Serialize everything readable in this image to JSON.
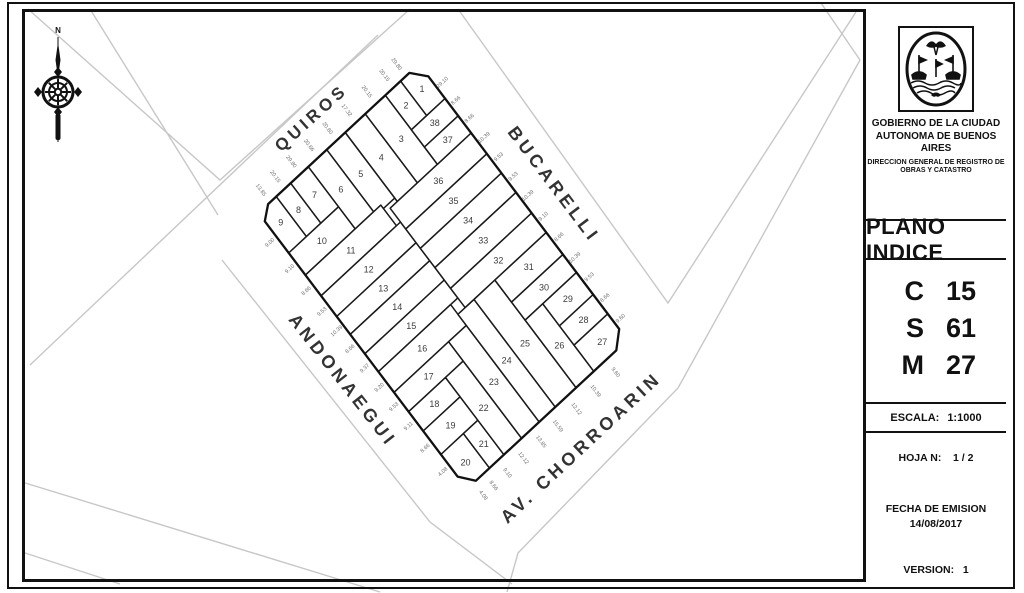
{
  "document": {
    "type_label": "PLANO INDICE",
    "org_line1": "GOBIERNO DE LA CIUDAD",
    "org_line2": "AUTONOMA DE BUENOS AIRES",
    "org_line3": "DIRECCION GENERAL DE REGISTRO DE",
    "org_line4": "OBRAS Y CATASTRO",
    "csm": [
      {
        "key": "C",
        "value": "15"
      },
      {
        "key": "S",
        "value": "61"
      },
      {
        "key": "M",
        "value": "27"
      }
    ],
    "escala_label": "ESCALA:",
    "escala_value": "1:1000",
    "hoja_label": "HOJA N:",
    "hoja_value": "1 / 2",
    "fecha_label": "FECHA DE EMISION",
    "fecha_value": "14/08/2017",
    "version_label": "VERSION:",
    "version_value": "1"
  },
  "colors": {
    "line": "#111111",
    "parcel_stroke": "#1a1a1a",
    "street_gray": "#c7c7c7",
    "label_gray": "#3d3d3d",
    "dim_gray": "#6e6e6e"
  },
  "map": {
    "compass": {
      "x": 58,
      "y": 92,
      "north_label": "N"
    },
    "frame": {
      "origin": [
        419,
        64
      ],
      "u": [
        208.5,
        276.0
      ],
      "v": [
        -160.5,
        149.0
      ]
    },
    "outline": [
      [
        0.045,
        0
      ],
      [
        0.96,
        0
      ],
      [
        1,
        0.07
      ],
      [
        1,
        0.945
      ],
      [
        0.955,
        1
      ],
      [
        0.03,
        1
      ],
      [
        0,
        0.94
      ],
      [
        0,
        0.06
      ]
    ],
    "streets": [
      {
        "name": "QUIROS",
        "x": 315,
        "y": 122,
        "rot": -42,
        "size": 17
      },
      {
        "name": "BUCARELLI",
        "x": 549,
        "y": 188,
        "rot": 53,
        "size": 18
      },
      {
        "name": "ANDONAEGUI",
        "x": 338,
        "y": 384,
        "rot": 52,
        "size": 18
      },
      {
        "name": "AV. CHORROARIN",
        "x": 585,
        "y": 452,
        "rot": -43,
        "size": 18
      }
    ],
    "parcels": [
      {
        "n": "1",
        "pts": [
          [
            0.045,
            0
          ],
          [
            0.125,
            0
          ],
          [
            0.125,
            0.115
          ],
          [
            0,
            0.115
          ],
          [
            0,
            0.06
          ]
        ]
      },
      {
        "n": "2",
        "pts": [
          [
            0,
            0.115
          ],
          [
            0.125,
            0.115
          ],
          [
            0.125,
            0.21
          ],
          [
            0,
            0.21
          ]
        ]
      },
      {
        "n": "3",
        "pts": [
          [
            0,
            0.21
          ],
          [
            0.25,
            0.21
          ],
          [
            0.25,
            0.335
          ],
          [
            0,
            0.335
          ]
        ]
      },
      {
        "n": "4",
        "pts": [
          [
            0,
            0.335
          ],
          [
            0.25,
            0.335
          ],
          [
            0.25,
            0.46
          ],
          [
            0,
            0.46
          ]
        ]
      },
      {
        "n": "5",
        "pts": [
          [
            0,
            0.46
          ],
          [
            0.2375,
            0.46
          ],
          [
            0.2375,
            0.575
          ],
          [
            0,
            0.575
          ]
        ]
      },
      {
        "n": "6",
        "pts": [
          [
            0,
            0.575
          ],
          [
            0.225,
            0.575
          ],
          [
            0.225,
            0.69
          ],
          [
            0,
            0.69
          ]
        ]
      },
      {
        "n": "7",
        "pts": [
          [
            0,
            0.69
          ],
          [
            0.145,
            0.69
          ],
          [
            0.145,
            0.8
          ],
          [
            0,
            0.8
          ]
        ]
      },
      {
        "n": "8",
        "pts": [
          [
            0,
            0.8
          ],
          [
            0.145,
            0.8
          ],
          [
            0.145,
            0.89
          ],
          [
            0,
            0.89
          ]
        ]
      },
      {
        "n": "9",
        "pts": [
          [
            0,
            0.89
          ],
          [
            0.145,
            0.89
          ],
          [
            0.145,
            1
          ],
          [
            0.03,
            1
          ],
          [
            0,
            0.94
          ]
        ]
      },
      {
        "n": "10",
        "pts": [
          [
            0.145,
            0.69
          ],
          [
            0.225,
            0.69
          ],
          [
            0.225,
            1
          ],
          [
            0.145,
            1
          ]
        ]
      },
      {
        "n": "11",
        "pts": [
          [
            0.225,
            0.53
          ],
          [
            0.3,
            0.53
          ],
          [
            0.3,
            1
          ],
          [
            0.225,
            1
          ]
        ]
      },
      {
        "n": "12",
        "pts": [
          [
            0.3,
            0.505
          ],
          [
            0.375,
            0.505
          ],
          [
            0.375,
            1
          ],
          [
            0.3,
            1
          ]
        ]
      },
      {
        "n": "13",
        "pts": [
          [
            0.375,
            0.505
          ],
          [
            0.44,
            0.505
          ],
          [
            0.44,
            1
          ],
          [
            0.375,
            1
          ]
        ]
      },
      {
        "n": "14",
        "pts": [
          [
            0.44,
            0.505
          ],
          [
            0.51,
            0.505
          ],
          [
            0.51,
            1
          ],
          [
            0.44,
            1
          ]
        ]
      },
      {
        "n": "15",
        "pts": [
          [
            0.51,
            0.505
          ],
          [
            0.575,
            0.505
          ],
          [
            0.575,
            1
          ],
          [
            0.51,
            1
          ]
        ]
      },
      {
        "n": "16",
        "pts": [
          [
            0.575,
            0.55
          ],
          [
            0.65,
            0.55
          ],
          [
            0.65,
            1
          ],
          [
            0.575,
            1
          ]
        ]
      },
      {
        "n": "17",
        "pts": [
          [
            0.65,
            0.66
          ],
          [
            0.72,
            0.66
          ],
          [
            0.72,
            1
          ],
          [
            0.65,
            1
          ]
        ]
      },
      {
        "n": "18",
        "pts": [
          [
            0.72,
            0.77
          ],
          [
            0.79,
            0.77
          ],
          [
            0.79,
            1
          ],
          [
            0.72,
            1
          ]
        ]
      },
      {
        "n": "19",
        "pts": [
          [
            0.79,
            0.77
          ],
          [
            0.875,
            0.77
          ],
          [
            0.875,
            1
          ],
          [
            0.79,
            1
          ]
        ]
      },
      {
        "n": "20",
        "pts": [
          [
            0.875,
            0.86
          ],
          [
            1,
            0.86
          ],
          [
            1,
            0.945
          ],
          [
            0.955,
            1
          ],
          [
            0.875,
            1
          ]
        ]
      },
      {
        "n": "21",
        "pts": [
          [
            0.875,
            0.77
          ],
          [
            1,
            0.77
          ],
          [
            1,
            0.86
          ],
          [
            0.875,
            0.86
          ]
        ]
      },
      {
        "n": "22",
        "pts": [
          [
            0.72,
            0.66
          ],
          [
            1,
            0.66
          ],
          [
            1,
            0.77
          ],
          [
            0.72,
            0.77
          ]
        ]
      },
      {
        "n": "23",
        "pts": [
          [
            0.65,
            0.55
          ],
          [
            1,
            0.55
          ],
          [
            1,
            0.66
          ],
          [
            0.65,
            0.66
          ]
        ]
      },
      {
        "n": "24",
        "pts": [
          [
            0.61,
            0.45
          ],
          [
            1,
            0.45
          ],
          [
            1,
            0.55
          ],
          [
            0.61,
            0.55
          ]
        ]
      },
      {
        "n": "25",
        "pts": [
          [
            0.61,
            0.32
          ],
          [
            1,
            0.32
          ],
          [
            1,
            0.45
          ],
          [
            0.61,
            0.45
          ]
        ]
      },
      {
        "n": "26",
        "pts": [
          [
            0.755,
            0.21
          ],
          [
            1,
            0.21
          ],
          [
            1,
            0.32
          ],
          [
            0.755,
            0.32
          ]
        ]
      },
      {
        "n": "27",
        "pts": [
          [
            0.905,
            0
          ],
          [
            0.96,
            0
          ],
          [
            1,
            0.07
          ],
          [
            1,
            0.21
          ],
          [
            0.905,
            0.21
          ]
        ]
      },
      {
        "n": "28",
        "pts": [
          [
            0.835,
            0
          ],
          [
            0.905,
            0
          ],
          [
            0.905,
            0.21
          ],
          [
            0.835,
            0.21
          ]
        ]
      },
      {
        "n": "29",
        "pts": [
          [
            0.755,
            0
          ],
          [
            0.835,
            0
          ],
          [
            0.835,
            0.21
          ],
          [
            0.755,
            0.21
          ]
        ]
      },
      {
        "n": "30",
        "pts": [
          [
            0.69,
            0
          ],
          [
            0.755,
            0
          ],
          [
            0.755,
            0.32
          ],
          [
            0.69,
            0.32
          ]
        ]
      },
      {
        "n": "31",
        "pts": [
          [
            0.61,
            0
          ],
          [
            0.69,
            0
          ],
          [
            0.69,
            0.32
          ],
          [
            0.61,
            0.32
          ]
        ]
      },
      {
        "n": "32",
        "pts": [
          [
            0.54,
            0
          ],
          [
            0.61,
            0
          ],
          [
            0.61,
            0.505
          ],
          [
            0.54,
            0.505
          ]
        ]
      },
      {
        "n": "33",
        "pts": [
          [
            0.465,
            0
          ],
          [
            0.54,
            0
          ],
          [
            0.54,
            0.505
          ],
          [
            0.465,
            0.505
          ]
        ]
      },
      {
        "n": "34",
        "pts": [
          [
            0.395,
            0
          ],
          [
            0.465,
            0
          ],
          [
            0.465,
            0.505
          ],
          [
            0.395,
            0.505
          ]
        ]
      },
      {
        "n": "35",
        "pts": [
          [
            0.325,
            0
          ],
          [
            0.395,
            0
          ],
          [
            0.395,
            0.505
          ],
          [
            0.325,
            0.505
          ]
        ]
      },
      {
        "n": "36",
        "pts": [
          [
            0.25,
            0
          ],
          [
            0.325,
            0
          ],
          [
            0.325,
            0.505
          ],
          [
            0.25,
            0.505
          ]
        ]
      },
      {
        "n": "37",
        "pts": [
          [
            0.1875,
            0
          ],
          [
            0.25,
            0
          ],
          [
            0.25,
            0.21
          ],
          [
            0.1875,
            0.21
          ]
        ]
      },
      {
        "n": "38",
        "pts": [
          [
            0.125,
            0
          ],
          [
            0.1875,
            0
          ],
          [
            0.1875,
            0.21
          ],
          [
            0.125,
            0.21
          ]
        ]
      }
    ],
    "dims": {
      "bucarelli": {
        "fixed": "t",
        "offset": -0.035,
        "rot": -42,
        "items": [
          {
            "p": 0.09,
            "v": "29.10"
          },
          {
            "p": 0.155,
            "v": "8.66"
          },
          {
            "p": 0.22,
            "v": "8.66"
          },
          {
            "p": 0.29,
            "v": "10.39"
          },
          {
            "p": 0.36,
            "v": "9.53"
          },
          {
            "p": 0.43,
            "v": "9.53"
          },
          {
            "p": 0.5,
            "v": "10.39"
          },
          {
            "p": 0.575,
            "v": "9.10"
          },
          {
            "p": 0.65,
            "v": "8.66"
          },
          {
            "p": 0.725,
            "v": "10.39"
          },
          {
            "p": 0.795,
            "v": "9.53"
          },
          {
            "p": 0.87,
            "v": "8.66"
          },
          {
            "p": 0.945,
            "v": "9.60"
          }
        ]
      },
      "quiros": {
        "fixed": "s",
        "offset": -0.045,
        "rot": 53,
        "items": [
          {
            "p": 0.09,
            "v": "29.80"
          },
          {
            "p": 0.165,
            "v": "20.15"
          },
          {
            "p": 0.275,
            "v": "20.15"
          },
          {
            "p": 0.4,
            "v": "17.32"
          },
          {
            "p": 0.52,
            "v": "20.60"
          },
          {
            "p": 0.635,
            "v": "20.66"
          },
          {
            "p": 0.745,
            "v": "29.80"
          },
          {
            "p": 0.845,
            "v": "20.15"
          },
          {
            "p": 0.935,
            "v": "13.85"
          }
        ]
      },
      "andonaegui": {
        "fixed": "t",
        "offset": 1.04,
        "rot": -42,
        "items": [
          {
            "p": 0.09,
            "v": "9.00"
          },
          {
            "p": 0.185,
            "v": "9.10"
          },
          {
            "p": 0.265,
            "v": "8.66"
          },
          {
            "p": 0.34,
            "v": "9.53"
          },
          {
            "p": 0.41,
            "v": "10.39"
          },
          {
            "p": 0.475,
            "v": "8.66"
          },
          {
            "p": 0.545,
            "v": "9.37"
          },
          {
            "p": 0.615,
            "v": "9.20"
          },
          {
            "p": 0.685,
            "v": "9.53"
          },
          {
            "p": 0.755,
            "v": "9.11"
          },
          {
            "p": 0.835,
            "v": "8.66"
          },
          {
            "p": 0.92,
            "v": "4.08"
          }
        ]
      },
      "chorroarin": {
        "fixed": "s",
        "offset": 1.045,
        "rot": 53,
        "items": [
          {
            "p": 0.14,
            "v": "9.60"
          },
          {
            "p": 0.265,
            "v": "10.39"
          },
          {
            "p": 0.385,
            "v": "12.12"
          },
          {
            "p": 0.5,
            "v": "15.59"
          },
          {
            "p": 0.605,
            "v": "13.85"
          },
          {
            "p": 0.715,
            "v": "12.12"
          },
          {
            "p": 0.815,
            "v": "9.10"
          },
          {
            "p": 0.9,
            "v": "8.66"
          },
          {
            "p": 0.965,
            "v": "4.08"
          }
        ]
      }
    },
    "gray_lines": [
      [
        [
          28,
          9
        ],
        [
          220,
          180
        ],
        [
          410,
          9
        ]
      ],
      [
        [
          90,
          9
        ],
        [
          218,
          215
        ]
      ],
      [
        [
          378,
          35
        ],
        [
          30,
          365
        ]
      ],
      [
        [
          222,
          260
        ],
        [
          430,
          522
        ],
        [
          512,
          584
        ]
      ],
      [
        [
          22,
          482
        ],
        [
          380,
          592
        ]
      ],
      [
        [
          22,
          552
        ],
        [
          120,
          584
        ]
      ],
      [
        [
          458,
          9
        ],
        [
          668,
          303
        ],
        [
          856,
          12
        ]
      ],
      [
        [
          821,
          3
        ],
        [
          860,
          60
        ]
      ],
      [
        [
          860,
          60
        ],
        [
          678,
          388
        ],
        [
          518,
          553
        ],
        [
          507,
          592
        ]
      ]
    ]
  }
}
